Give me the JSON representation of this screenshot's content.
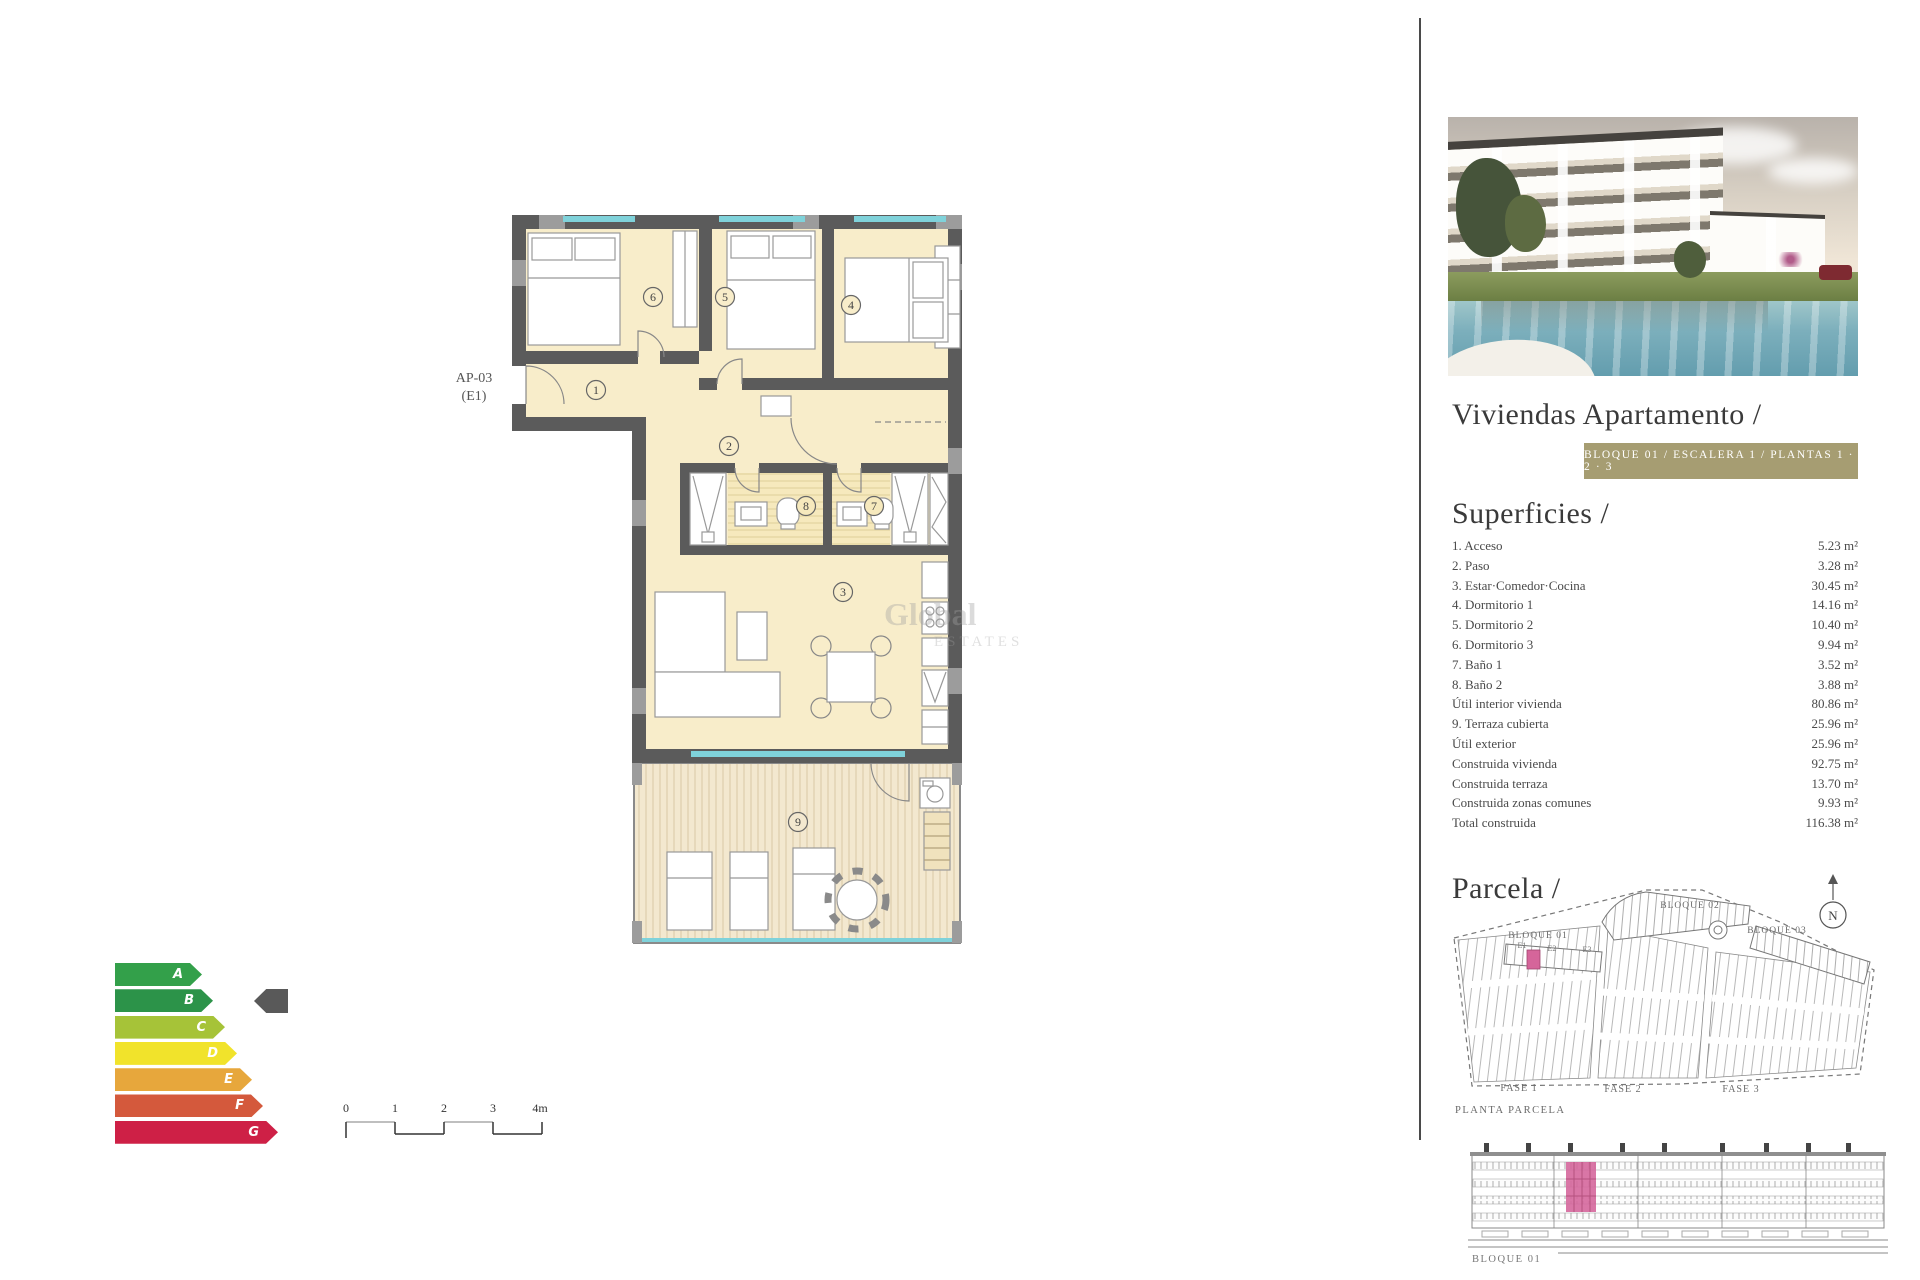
{
  "plan": {
    "unit_label_line1": "AP-03",
    "unit_label_line2": "(E1)",
    "rooms": [
      "1",
      "2",
      "3",
      "4",
      "5",
      "6",
      "7",
      "8",
      "9"
    ],
    "colors": {
      "wall": "#5b5b5b",
      "room_fill": "#f8edca",
      "terrace_fill": "#f3e8cf",
      "window": "#7fd2da"
    }
  },
  "watermark": {
    "line1": "Global",
    "line2": "ESTATES"
  },
  "scale_bar": {
    "labels": [
      "0",
      "1",
      "2",
      "3",
      "4m"
    ]
  },
  "energy": {
    "labels": [
      "A",
      "B",
      "C",
      "D",
      "E",
      "F",
      "G"
    ],
    "colors": [
      "#33a04a",
      "#2c9349",
      "#a6c338",
      "#f1e32b",
      "#e7a73c",
      "#d4593c",
      "#ce2046"
    ],
    "pointer_level": "B",
    "pointer_color": "#595959"
  },
  "panel": {
    "title": "Viviendas Apartamento /",
    "badge": "BLOQUE 01 / ESCALERA 1 / PLANTAS 1 · 2 · 3",
    "badge_color": "#a69d72",
    "superficies": {
      "heading": "Superficies /",
      "rows": [
        {
          "label": "1. Acceso",
          "value": "5.23 m²"
        },
        {
          "label": "2. Paso",
          "value": "3.28 m²"
        },
        {
          "label": "3. Estar·Comedor·Cocina",
          "value": "30.45 m²"
        },
        {
          "label": "4. Dormitorio 1",
          "value": "14.16 m²"
        },
        {
          "label": "5. Dormitorio 2",
          "value": "10.40 m²"
        },
        {
          "label": "6. Dormitorio 3",
          "value": "9.94 m²"
        },
        {
          "label": "7. Baño 1",
          "value": "3.52 m²"
        },
        {
          "label": "8. Baño 2",
          "value": "3.88 m²"
        },
        {
          "label": "Útil interior vivienda",
          "value": "80.86 m²"
        },
        {
          "label": "9. Terraza cubierta",
          "value": "25.96 m²"
        },
        {
          "label": "Útil exterior",
          "value": "25.96 m²"
        },
        {
          "label": "Construida vivienda",
          "value": "92.75 m²"
        },
        {
          "label": "Construida terraza",
          "value": "13.70 m²"
        },
        {
          "label": "Construida zonas comunes",
          "value": "9.93 m²"
        },
        {
          "label": "Total construida",
          "value": "116.38 m²"
        }
      ]
    },
    "parcela": {
      "heading": "Parcela /",
      "compass": "N",
      "labels": {
        "bloque01": "BLOQUE 01",
        "bloque02": "BLOQUE 02",
        "bloque03": "BLOQUE 03",
        "e1": "E1",
        "e2": "E2",
        "e3": "E3",
        "fase1": "FASE 1",
        "fase2": "FASE 2",
        "fase3": "FASE 3",
        "caption": "PLANTA PARCELA"
      },
      "highlight_color": "#d5659a"
    },
    "elevation": {
      "caption": "BLOQUE 01",
      "highlight_color": "#d5679c"
    }
  }
}
